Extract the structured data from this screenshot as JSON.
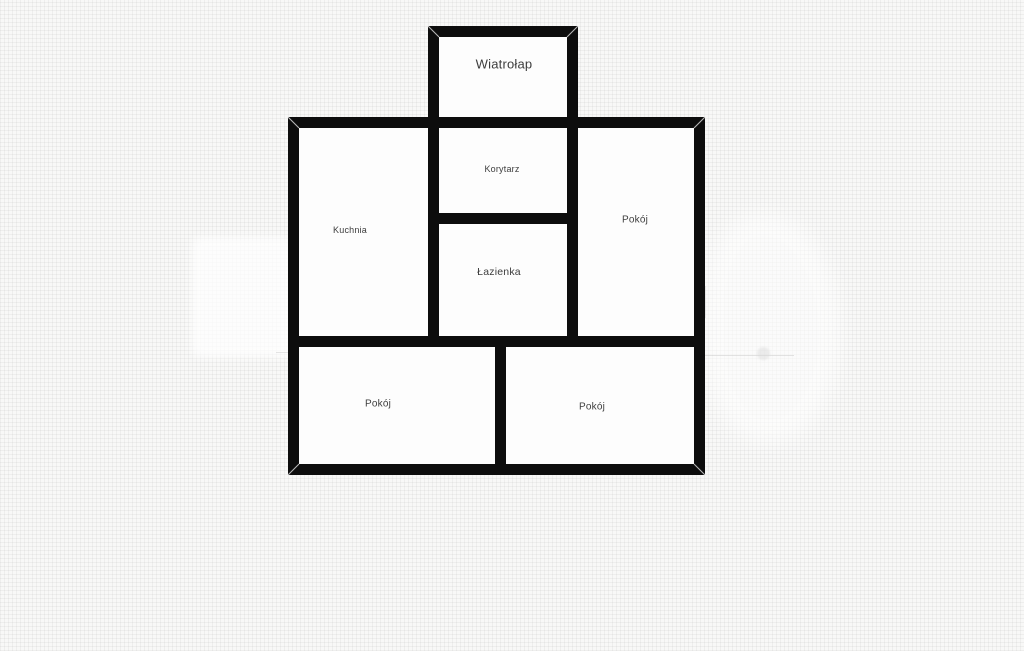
{
  "theme": {
    "background_color": "#f8f8f7",
    "wall_color": "#0d0d0d",
    "room_fill_color": "#fdfdfd",
    "label_color": "#3d3d3d"
  },
  "floorplan": {
    "rooms": [
      {
        "id": "wiatrolap",
        "label": "Wiatrołap"
      },
      {
        "id": "korytarz",
        "label": "Korytarz"
      },
      {
        "id": "kuchnia",
        "label": "Kuchnia"
      },
      {
        "id": "lazienka",
        "label": "Łazienka"
      },
      {
        "id": "pokoj-right",
        "label": "Pokój"
      },
      {
        "id": "pokoj-bottom-left",
        "label": "Pokój"
      },
      {
        "id": "pokoj-bottom-right",
        "label": "Pokój"
      }
    ]
  }
}
